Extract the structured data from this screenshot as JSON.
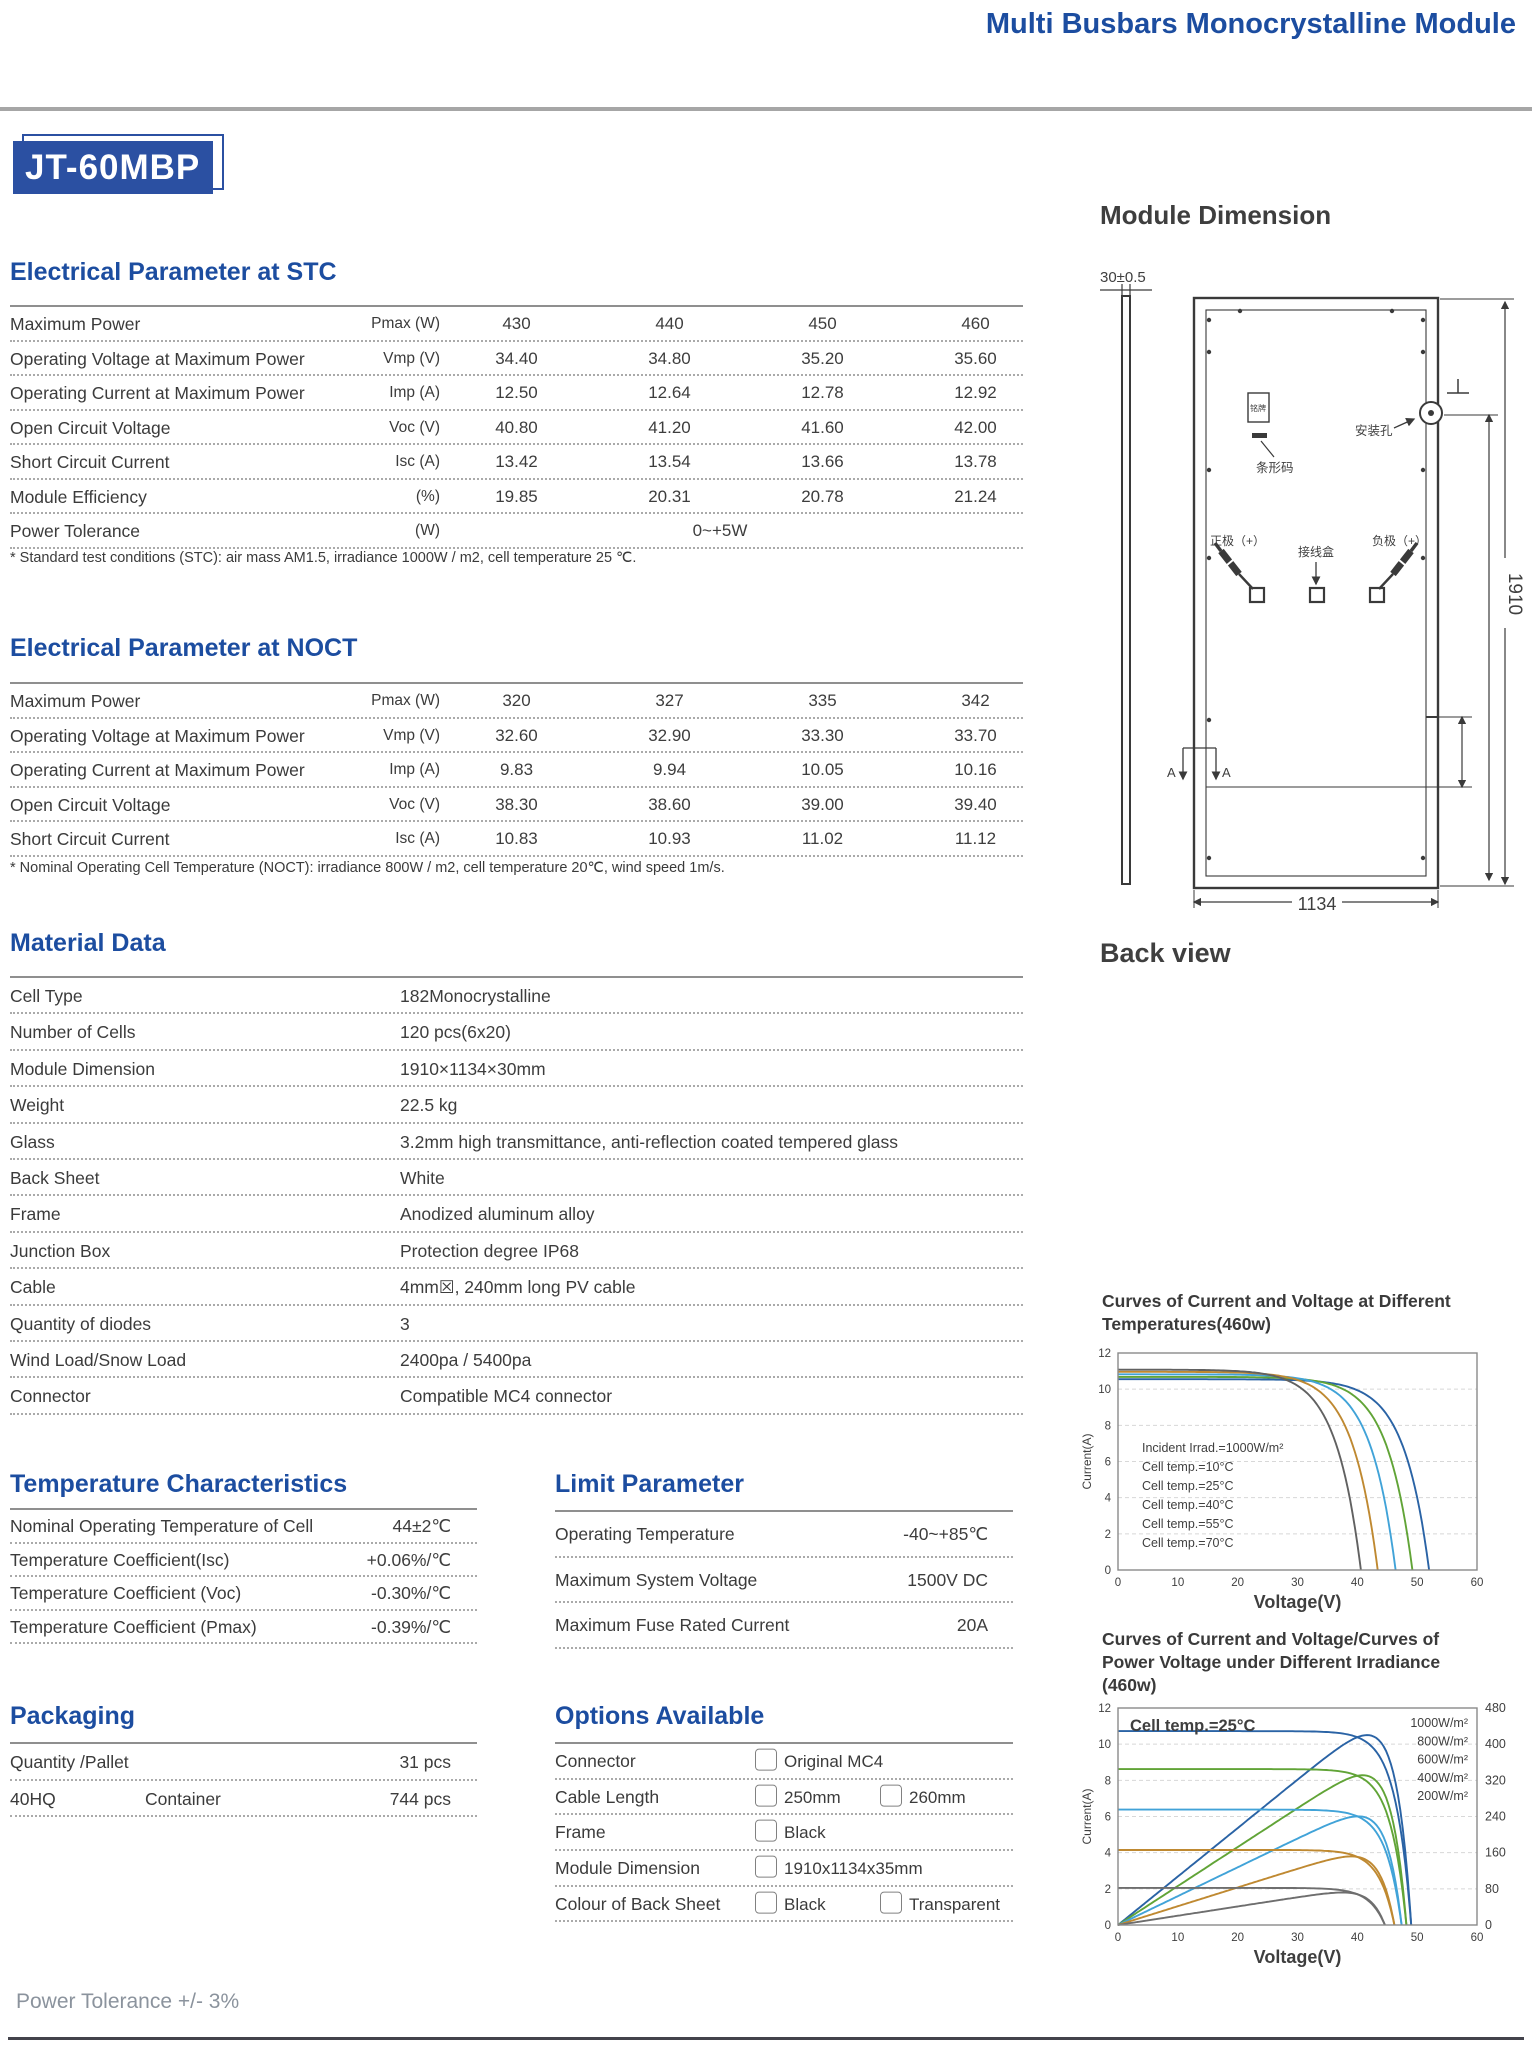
{
  "header": {
    "title": "Multi Busbars Monocrystalline Module",
    "model": "JT-60MBP",
    "accent_color": "#1c4da0"
  },
  "stc": {
    "heading": "Electrical Parameter at STC",
    "rows": [
      {
        "label": "Maximum Power",
        "symbol": "Pmax (W)",
        "values": [
          "430",
          "440",
          "450",
          "460"
        ]
      },
      {
        "label": "Operating Voltage at Maximum Power",
        "symbol": "Vmp (V)",
        "values": [
          "34.40",
          "34.80",
          "35.20",
          "35.60"
        ]
      },
      {
        "label": "Operating Current at Maximum Power",
        "symbol": "Imp (A)",
        "values": [
          "12.50",
          "12.64",
          "12.78",
          "12.92"
        ]
      },
      {
        "label": "Open Circuit Voltage",
        "symbol": "Voc (V)",
        "values": [
          "40.80",
          "41.20",
          "41.60",
          "42.00"
        ]
      },
      {
        "label": "Short Circuit Current",
        "symbol": "Isc (A)",
        "values": [
          "13.42",
          "13.54",
          "13.66",
          "13.78"
        ]
      },
      {
        "label": "Module Efficiency",
        "symbol": "(%)",
        "values": [
          "19.85",
          "20.31",
          "20.78",
          "21.24"
        ]
      }
    ],
    "tolerance": {
      "label": "Power Tolerance",
      "symbol": "(W)",
      "value": "0~+5W"
    },
    "footnote": "* Standard test conditions (STC): air mass AM1.5, irradiance 1000W / m2, cell temperature 25 ℃."
  },
  "noct": {
    "heading": "Electrical Parameter at NOCT",
    "rows": [
      {
        "label": "Maximum Power",
        "symbol": "Pmax (W)",
        "values": [
          "320",
          "327",
          "335",
          "342"
        ]
      },
      {
        "label": "Operating Voltage at Maximum Power",
        "symbol": "Vmp (V)",
        "values": [
          "32.60",
          "32.90",
          "33.30",
          "33.70"
        ]
      },
      {
        "label": "Operating Current at Maximum Power",
        "symbol": "Imp (A)",
        "values": [
          "9.83",
          "9.94",
          "10.05",
          "10.16"
        ]
      },
      {
        "label": "Open Circuit Voltage",
        "symbol": "Voc (V)",
        "values": [
          "38.30",
          "38.60",
          "39.00",
          "39.40"
        ]
      },
      {
        "label": "Short Circuit Current",
        "symbol": "Isc (A)",
        "values": [
          "10.83",
          "10.93",
          "11.02",
          "11.12"
        ]
      }
    ],
    "footnote": "* Nominal Operating Cell Temperature (NOCT): irradiance 800W / m2, cell temperature 20℃, wind speed 1m/s."
  },
  "material": {
    "heading": "Material Data",
    "rows": [
      {
        "label": "Cell Type",
        "value": "182Monocrystalline"
      },
      {
        "label": "Number of Cells",
        "value": "120 pcs(6x20)"
      },
      {
        "label": "Module Dimension",
        "value": "1910×1134×30mm"
      },
      {
        "label": "Weight",
        "value": "22.5 kg"
      },
      {
        "label": "Glass",
        "value": "3.2mm high transmittance, anti-reflection coated tempered glass"
      },
      {
        "label": "Back Sheet",
        "value": "White"
      },
      {
        "label": "Frame",
        "value": "Anodized aluminum alloy"
      },
      {
        "label": "Junction Box",
        "value": "Protection degree IP68"
      },
      {
        "label": "Cable",
        "value": "4mm☒, 240mm long PV cable"
      },
      {
        "label": "Quantity of diodes",
        "value": "3"
      },
      {
        "label": "Wind Load/Snow Load",
        "value": "2400pa / 5400pa"
      },
      {
        "label": "Connector",
        "value": "Compatible MC4 connector"
      }
    ]
  },
  "temperature": {
    "heading": "Temperature Characteristics",
    "rows": [
      {
        "label": "Nominal Operating Temperature of Cell",
        "value": "44±2℃"
      },
      {
        "label": "Temperature Coefficient(Isc)",
        "value": "+0.06%/℃"
      },
      {
        "label": "Temperature Coefficient (Voc)",
        "value": "-0.30%/℃"
      },
      {
        "label": "Temperature Coefficient (Pmax)",
        "value": "-0.39%/℃"
      }
    ]
  },
  "limit": {
    "heading": "Limit Parameter",
    "rows": [
      {
        "label": "Operating Temperature",
        "value": "-40~+85℃"
      },
      {
        "label": "Maximum System Voltage",
        "value": "1500V DC"
      },
      {
        "label": "Maximum Fuse Rated Current",
        "value": "20A"
      }
    ]
  },
  "packaging": {
    "heading": "Packaging",
    "rows": [
      {
        "cells": [
          "Quantity /Pallet",
          "",
          "31 pcs"
        ]
      },
      {
        "cells": [
          "40HQ",
          "Container",
          "744 pcs"
        ]
      }
    ]
  },
  "options": {
    "heading": "Options Available",
    "rows": [
      {
        "label": "Connector",
        "choices": [
          "Original MC4"
        ]
      },
      {
        "label": "Cable Length",
        "choices": [
          "250mm",
          "260mm"
        ]
      },
      {
        "label": "Frame",
        "choices": [
          "Black"
        ]
      },
      {
        "label": "Module Dimension",
        "choices": [
          "1910x1134x35mm"
        ]
      },
      {
        "label": "Colour of Back Sheet",
        "choices": [
          "Black",
          "Transparent"
        ]
      }
    ]
  },
  "module_dimension": {
    "heading": "Module Dimension",
    "thickness_label": "30±0.5",
    "height_label": "1910",
    "width_label": "1134",
    "back_view_label": "Back view",
    "labels": {
      "nameplate": "铭牌",
      "barcode": "条形码",
      "mounting_hole": "安装孔",
      "positive": "正极（+）",
      "junction_box": "接线盒",
      "negative": "负极（+）",
      "section_a": "A"
    }
  },
  "footer": {
    "power_tolerance": "Power Tolerance +/- 3%"
  },
  "chart_data": [
    {
      "type": "line",
      "title": "Curves of Current and Voltage at Different Temperatures(460w)",
      "title_lines": [
        "Curves of Current and Voltage at Different",
        "Temperatures(460w)"
      ],
      "xlabel": "Voltage(V)",
      "ylabel": "Current(A)",
      "xlim": [
        0,
        60
      ],
      "ylim": [
        0,
        12
      ],
      "xticks": [
        0,
        10,
        20,
        30,
        40,
        50,
        60
      ],
      "yticks": [
        0,
        2,
        4,
        6,
        8,
        10,
        12
      ],
      "grid": "dashed-horizontal",
      "legend_position": "inside-left",
      "legend_note": {
        "text": "Incident Irrad.=1000W/m²",
        "color": "#5a5a5a"
      },
      "model": {
        "form": "I=Isc*(1-exp((V-Voc)/a))",
        "a": 4.2
      },
      "series": [
        {
          "name": "Cell temp.=10°C",
          "color": "#2a63a5",
          "isc": 10.55,
          "voc": 52.0
        },
        {
          "name": "Cell temp.=25°C",
          "color": "#61a437",
          "isc": 10.68,
          "voc": 49.2
        },
        {
          "name": "Cell temp.=40°C",
          "color": "#41a3d8",
          "isc": 10.82,
          "voc": 46.4
        },
        {
          "name": "Cell temp.=55°C",
          "color": "#bf8931",
          "isc": 10.96,
          "voc": 43.4
        },
        {
          "name": "Cell temp.=70°C",
          "color": "#616161",
          "isc": 11.08,
          "voc": 40.6
        }
      ]
    },
    {
      "type": "line",
      "title": "Curves of Current and Voltage/Curves of Power Voltage under Different Irradiance (460w)",
      "title_lines": [
        "Curves of Current and Voltage/Curves of",
        "Power Voltage under Different Irradiance",
        "(460w)"
      ],
      "xlabel": "Voltage(V)",
      "ylabel": "Current(A)",
      "xlim": [
        0,
        60
      ],
      "ylim": [
        0,
        12
      ],
      "y2lim": [
        0,
        480
      ],
      "xticks": [
        0,
        10,
        20,
        30,
        40,
        50,
        60
      ],
      "yticks": [
        0,
        2,
        4,
        6,
        8,
        10,
        12
      ],
      "y2ticks": [
        0,
        80,
        160,
        240,
        320,
        400,
        480
      ],
      "grid": "dashed-horizontal",
      "annotation": "Cell temp.=25°C",
      "legend_position": "inside-right",
      "power_curves": true,
      "power_scale": 40,
      "model": {
        "form": "I=Isc*(1-exp((V-Voc)/a)); P=V*I",
        "a": 2.6
      },
      "series": [
        {
          "name": "1000W/m²",
          "color": "#2a63a5",
          "isc": 10.72,
          "voc": 49.0
        },
        {
          "name": "800W/m²",
          "color": "#61a437",
          "isc": 8.62,
          "voc": 48.2
        },
        {
          "name": "600W/m²",
          "color": "#41a3d8",
          "isc": 6.38,
          "voc": 47.4
        },
        {
          "name": "400W/m²",
          "color": "#bf8931",
          "isc": 4.15,
          "voc": 46.2
        },
        {
          "name": "200W/m²",
          "color": "#6e6e6e",
          "isc": 2.05,
          "voc": 44.6
        }
      ]
    }
  ]
}
